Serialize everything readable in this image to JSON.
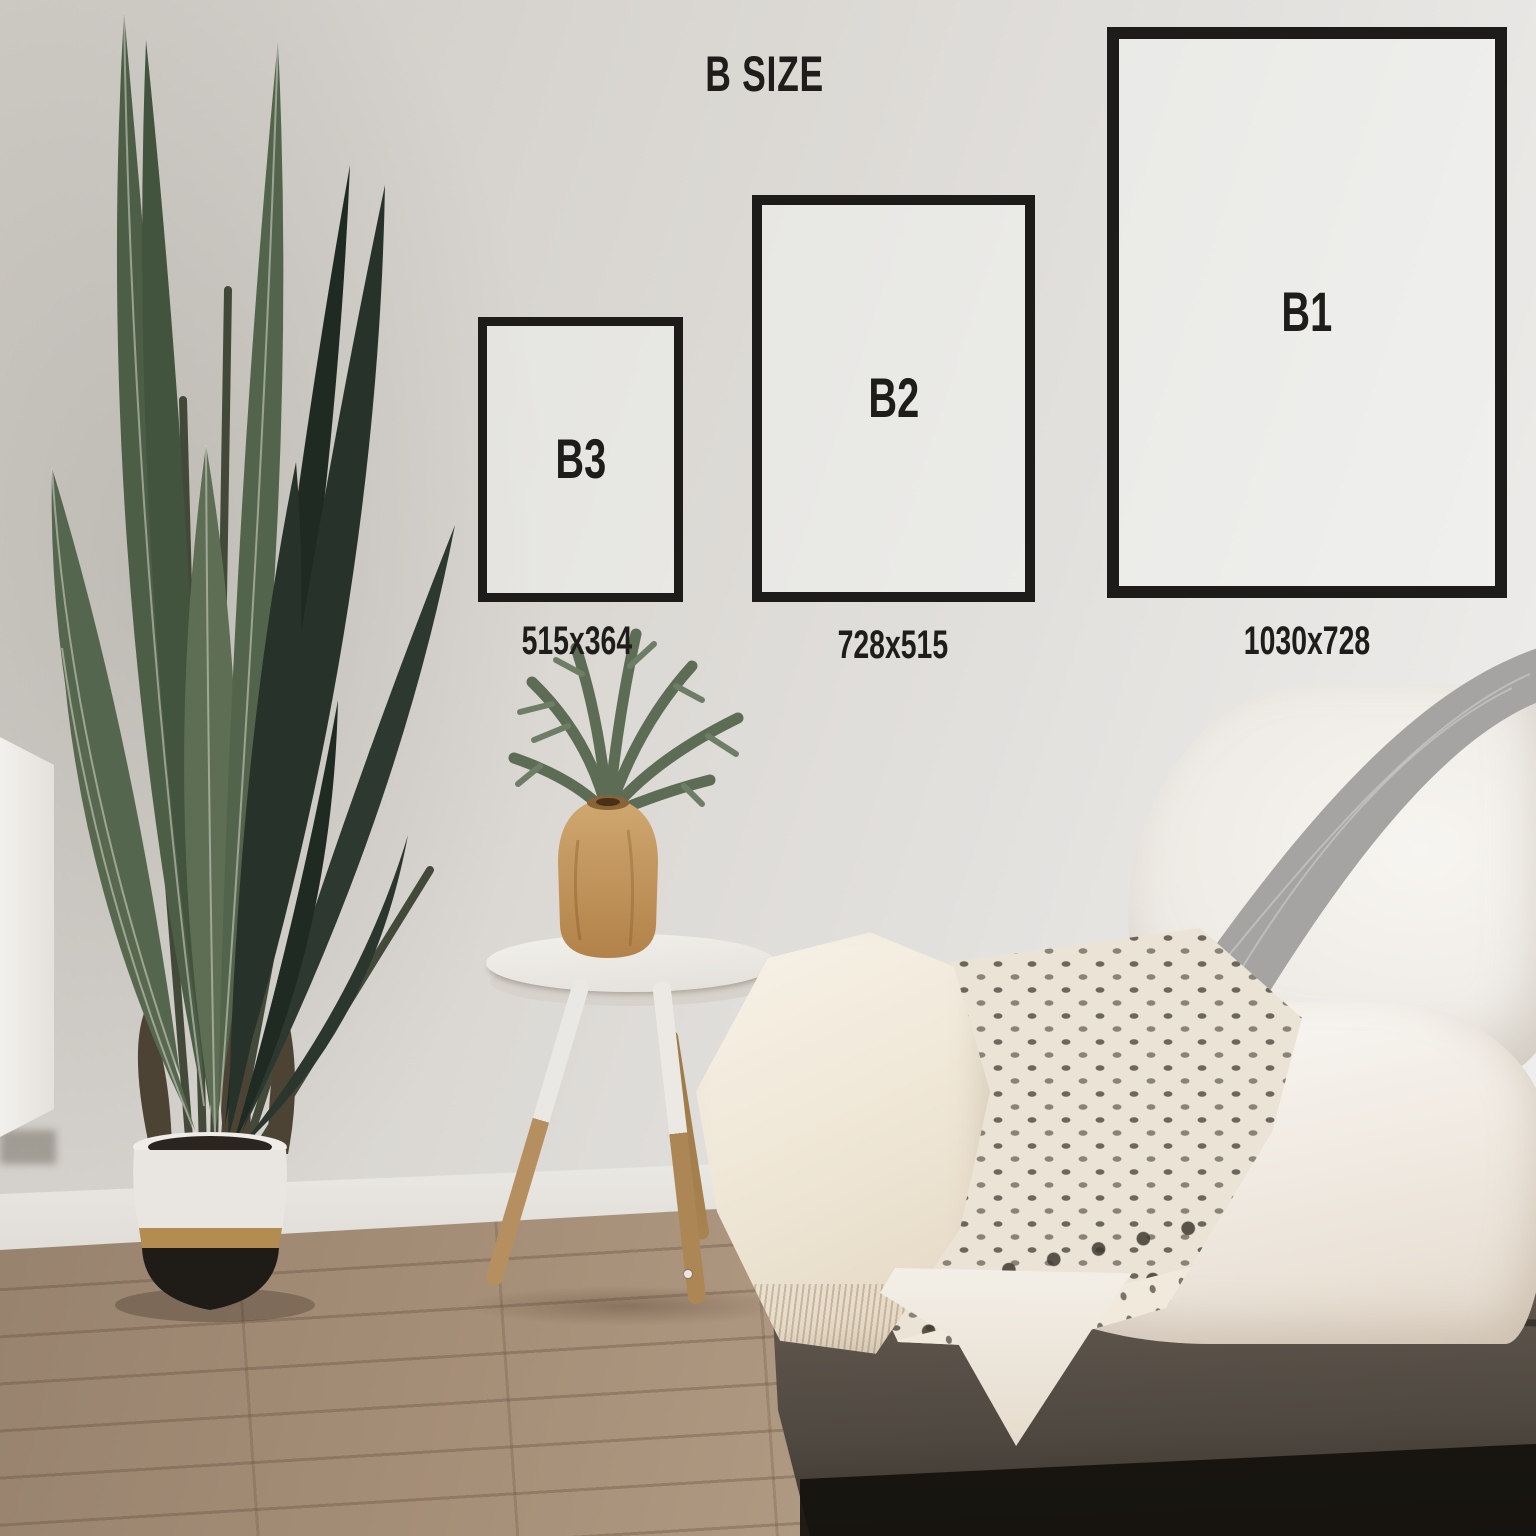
{
  "title": "B SIZE",
  "sizes": [
    {
      "label": "B3",
      "dimensions": "515x364"
    },
    {
      "label": "B2",
      "dimensions": "728x515"
    },
    {
      "label": "B1",
      "dimensions": "1030x728"
    }
  ],
  "colors": {
    "text": "#1e1d1b",
    "frame_border": "#1d1c1a",
    "wall": "#dcdad6",
    "floor_wood": "#a58e77",
    "plant_green": "#52644b",
    "plant_dark_green": "#242f27",
    "pot_white": "#e9e6e1",
    "pot_gold": "#b38c51",
    "pot_black": "#1f1b17",
    "table_white": "#edebe7",
    "table_leg_wood": "#b68f60",
    "vase_wood": "#c49a63",
    "fern_green": "#64735c",
    "sofa_fabric": "#60574e",
    "knit_throw_gray": "#a5a4a2",
    "fluffy_blanket": "#f4f1ec",
    "block_print_cream": "#ebe3d6",
    "block_print_motif": "#565046"
  }
}
